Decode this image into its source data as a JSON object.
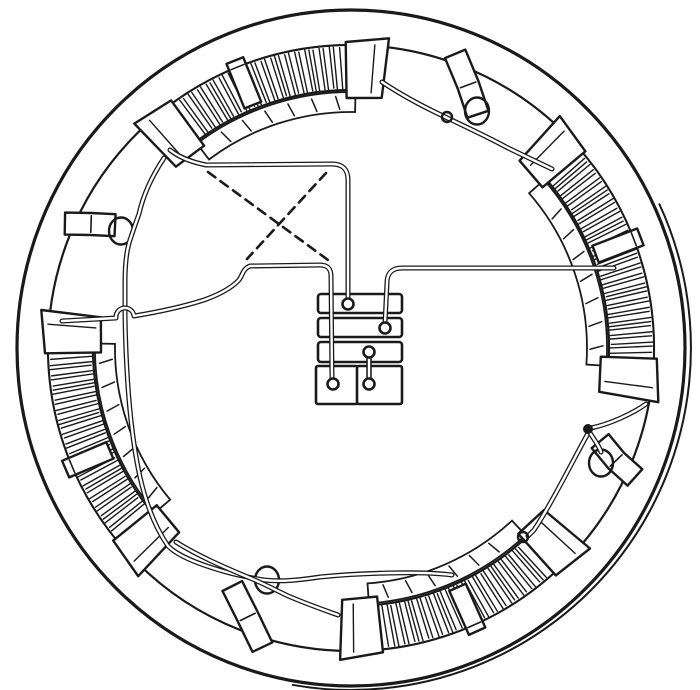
{
  "scene": {
    "width": 700,
    "height": 690,
    "background": "#ffffff",
    "ink": "#1a1a1a",
    "description": "Engraved line illustration: four-pole field winding inside a circular motor frame. Four hatched field coils lie on the inner rim, held by clamp tabs; four bent wire clips sit in the gaps between coils; connecting wires (drawn as double lines) run to a central terminal board with three bars, two pads, five screw terminals and one jumper link; two dashed lines cross between the upper connecting wires."
  },
  "frame": {
    "cx": 351,
    "cy": 348,
    "outer_rx": 334,
    "outer_ry": 338,
    "outer2_rx": 340,
    "outer2_ry": 342,
    "outer2_a1": -100,
    "outer2_a2": 25,
    "inner_r": 303
  },
  "coil_style": {
    "r_out": 302,
    "r_in": 258,
    "face_out": 256,
    "face_in": 236,
    "cap_r1": 252,
    "cap_r2": 312,
    "cap_span": 8,
    "tab_r1": 262,
    "tab_r2": 310,
    "tab_halfwidth": 9,
    "hatch_step": 0.95,
    "hatch_r1": 259,
    "hatch_r2": 301,
    "face_tick_step": 5.5
  },
  "coils": [
    {
      "id": "field-coil-top",
      "a1": 83,
      "a2": 134,
      "tab": 112
    },
    {
      "id": "field-coil-right",
      "a1": -10,
      "a2": 48,
      "tab": 21
    },
    {
      "id": "field-coil-left",
      "a1": 173,
      "a2": 227,
      "tab": 203
    },
    {
      "id": "field-coil-bottom",
      "a1": -92,
      "a2": -40,
      "tab": -66
    }
  ],
  "clip_style": {
    "half_w": 11,
    "r_out": 312,
    "r_mid": 288,
    "r_in": 266,
    "loop_rx": 12,
    "loop_ry": 13.5
  },
  "clips": [
    {
      "id": "cable-clip-upper-right",
      "a_out": 70.5,
      "a_mid": 66,
      "a_in": 61.5,
      "loop": [
        477,
        111
      ]
    },
    {
      "id": "cable-clip-left",
      "a_out": 156.5,
      "a_mid": 154.5,
      "a_in": 152.5,
      "loop": [
        121,
        231
      ]
    },
    {
      "id": "cable-clip-lower-left",
      "a_out": 253.5,
      "a_mid": 249,
      "a_in": 243.5,
      "loop": [
        267,
        580
      ]
    },
    {
      "id": "cable-clip-lower-right",
      "a_out": -24.5,
      "a_mid": -23,
      "a_in": -20.5,
      "loop": [
        601,
        463
      ]
    }
  ],
  "wires": [
    {
      "id": "wire-top-coil-left-to-terminal-1",
      "d": "M 170,150 C 180,158 192,162 206,165 L 332,164 Q 348,164 348,180 L 348,299"
    },
    {
      "id": "wire-top-coil-via-clips-to-bottom-coil",
      "d": "M 164,158 C 152,176 143,196 139,214 C 136,222 133,231 130,240 C 126,252 125,266 125,282 L 125,316 C 126,372 130,432 140,477 C 147,508 157,530 168,546 C 178,556 198,564 226,572 C 240,576 252,578 264,580 C 282,582 300,580 320,577 C 360,573 420,571 452,575"
    },
    {
      "id": "wire-left-coil-to-bottom-coil",
      "d": "M 176,542 C 198,556 226,568 250,578 C 260,582 272,588 286,595 C 304,603 324,610 338,615"
    },
    {
      "id": "wire-left-coil-to-terminal-4",
      "d": "M 62,321 C 82,320 100,319 116,318 A 9 9 0 0 1 134,316 C 158,312 182,307 204,300 C 218,295 230,289 238,281 C 243,276 242,269 250,266 L 320,265 Q 331,265 331,276 L 332,379"
    },
    {
      "id": "wire-terminal-2-to-right-coil",
      "d": "M 385,323 L 387,283 Q 387,268 402,268 L 614,268"
    },
    {
      "id": "wire-top-coil-to-right-coil",
      "d": "M 382,82 C 400,94 420,105 441,115 C 462,125 486,136 508,148 L 552,169"
    },
    {
      "id": "wire-right-coil-to-bottom-coil",
      "d": "M 646,404 C 632,414 610,424 591,428 C 573,460 552,503 534,530 L 528,536"
    },
    {
      "id": "wire-clip-lasso-lower-right",
      "d": "M 590,433 C 596,442 600,448 601,452"
    }
  ],
  "dashed_links": [
    {
      "id": "dashed-cross-link-1",
      "x1": 208,
      "y1": 172,
      "x2": 328,
      "y2": 260
    },
    {
      "id": "dashed-cross-link-2",
      "x1": 326,
      "y1": 173,
      "x2": 247,
      "y2": 259
    }
  ],
  "marks": [
    {
      "id": "wire-knot-upper-right",
      "x": 447,
      "y": 117,
      "r": 5,
      "filled": false
    },
    {
      "id": "junction-dot-right",
      "x": 588,
      "y": 429,
      "r": 3.8,
      "filled": true
    },
    {
      "id": "wire-eyelet-bottom",
      "x": 523,
      "y": 537,
      "r": 5,
      "filled": false
    }
  ],
  "terminal_board": {
    "bars": [
      [
        318,
        294,
        84,
        19
      ],
      [
        318,
        318,
        84,
        19
      ],
      [
        318,
        342,
        84,
        20
      ]
    ],
    "pads": [
      [
        316,
        366,
        42,
        38
      ],
      [
        357,
        366,
        45,
        38
      ]
    ],
    "terminals": [
      {
        "id": "terminal-1",
        "x": 348,
        "y": 304
      },
      {
        "id": "terminal-2",
        "x": 385,
        "y": 328
      },
      {
        "id": "terminal-3",
        "x": 369,
        "y": 352
      },
      {
        "id": "terminal-4",
        "x": 333,
        "y": 384
      },
      {
        "id": "terminal-5",
        "x": 369,
        "y": 384
      }
    ],
    "jumper": {
      "x": 369,
      "y1": 356,
      "y2": 380
    }
  }
}
